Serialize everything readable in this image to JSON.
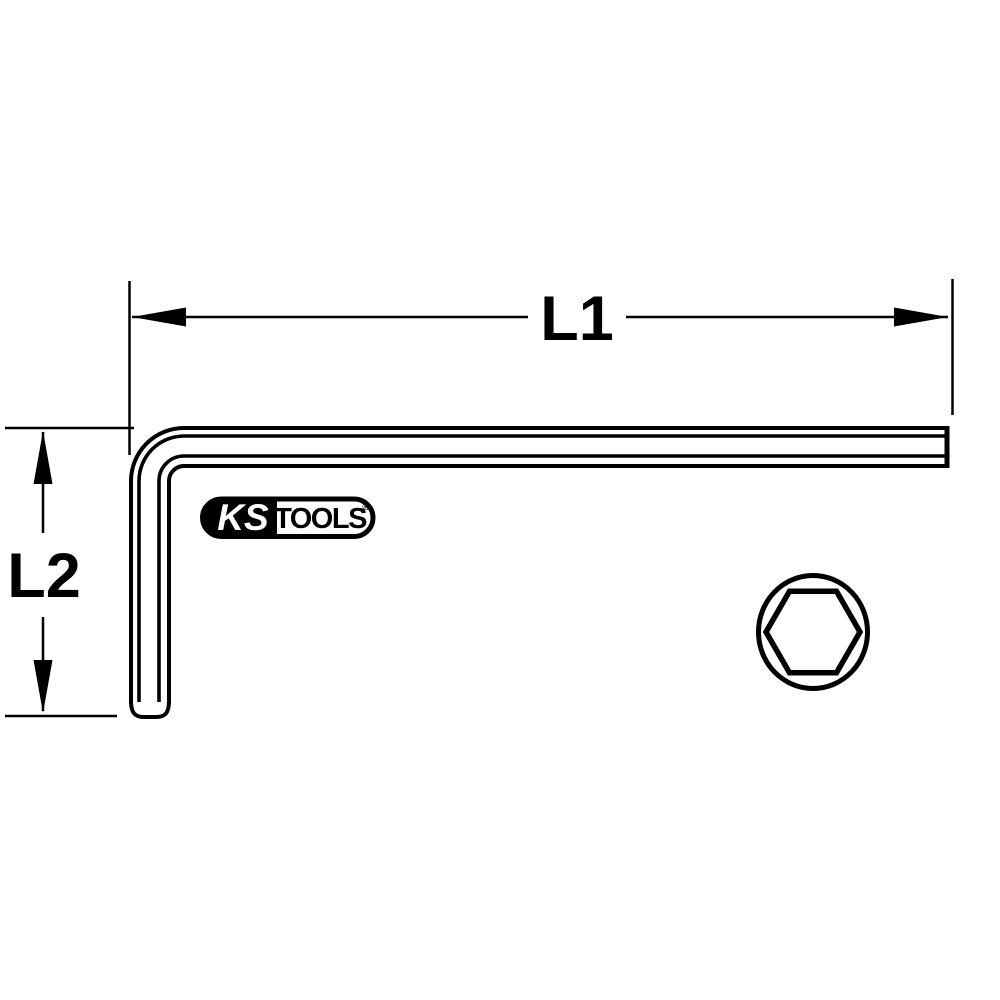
{
  "drawing": {
    "type": "technical-line-drawing",
    "subject": "L-shaped hex key with dimension callouts and hexagonal cross-section",
    "background_color": "#ffffff",
    "line_color": "#000000",
    "dimension_l1": {
      "label": "L1"
    },
    "dimension_l2": {
      "label": "L2"
    },
    "logo": {
      "ks": "KS",
      "tools": "TOOLS",
      "registered": "®"
    }
  }
}
